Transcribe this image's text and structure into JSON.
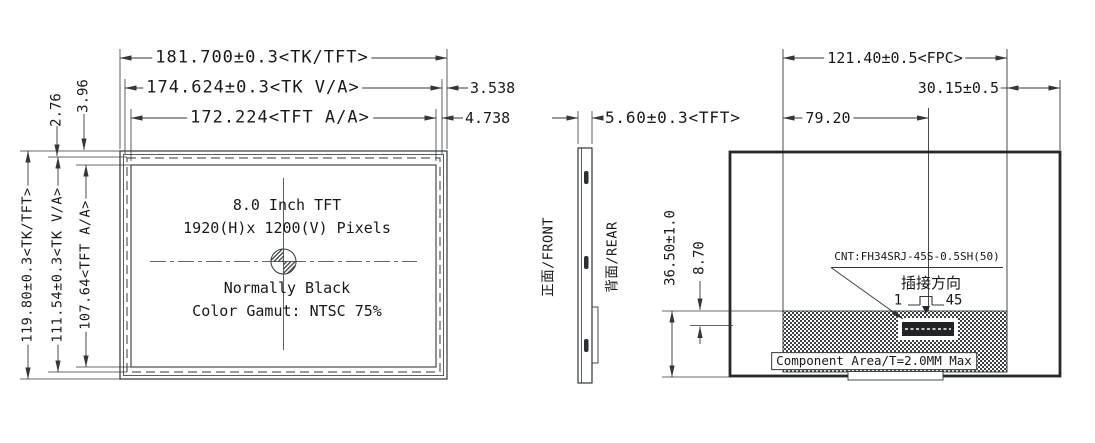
{
  "front_view": {
    "width_dims": {
      "tk": "181.700±0.3<TK/TFT>",
      "va": "174.624±0.3<TK V/A>",
      "aa": "172.224<TFT A/A>"
    },
    "right_offsets": {
      "va_edge": "3.538",
      "aa_edge": "4.738"
    },
    "height_dims": {
      "tk": "119.80±0.3<TK/TFT>",
      "va": "111.54±0.3<TK V/A>",
      "aa": "107.64<TFT A/A>"
    },
    "top_offsets": {
      "offset_a": "3.96",
      "offset_b": "2.76"
    },
    "panel_text": {
      "line1": "8.0 Inch TFT",
      "line2": "1920(H)x 1200(V) Pixels",
      "line3": "Normally Black",
      "line4": "Color Gamut: NTSC 75%"
    }
  },
  "side_view": {
    "thickness_dim": "5.60±0.3<TFT>",
    "front_label": "正面/FRONT",
    "rear_label": "背面/REAR"
  },
  "rear_view": {
    "fpc_width_dim": "121.40±0.5<FPC>",
    "right_offset_dim": "30.15±0.5",
    "connector_x_dim": "79.20",
    "component_height_dim": "36.50±1.0",
    "connector_offset_dim": "8.70",
    "connector_label": "CNT:FH34SRJ-45S-0.5SH(50)",
    "insertion_direction_label": "插接方向",
    "pin_first": "1",
    "pin_last": "45",
    "component_area_label": "Component Area/T=2.0MM Max"
  },
  "colors": {
    "line": "#33373b",
    "text": "#17191c",
    "background": "#ffffff"
  }
}
